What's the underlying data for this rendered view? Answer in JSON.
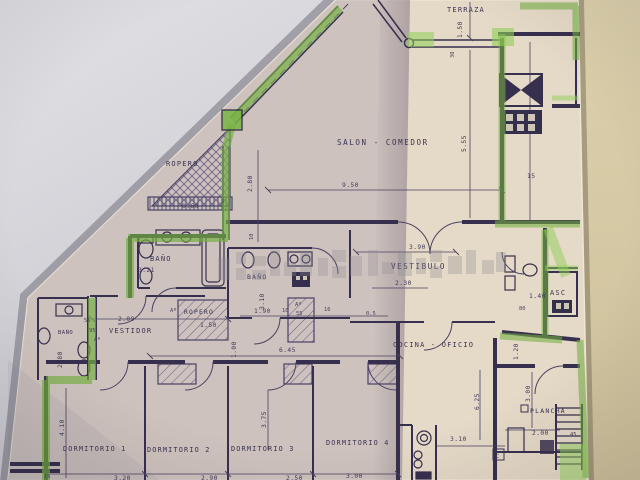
{
  "plan": {
    "rooms": {
      "terraza": "TERRAZA",
      "salon_comedor": "SALON - COMEDOR",
      "ropero_top": "ROPERO",
      "bano_left": "BAÑO",
      "bano_mid": "BAÑO",
      "bano_small": "BAÑO",
      "vestibulo": "VESTIBULO",
      "vestidor": "VESTIDOR",
      "ropero_mid": "ROPERO",
      "cocina_oficio": "COCINA - OFICIO",
      "dormitorio_1": "DORMITORIO 1",
      "dormitorio_2": "DORMITORIO 2",
      "dormitorio_3": "DORMITORIO 3",
      "dormitorio_4": "DORMITORIO 4",
      "plancha": "PLANCHA",
      "ascensor": "ASC"
    },
    "marks": {
      "closet": "Aº",
      "c_box": "C"
    },
    "dims": {
      "terraza_depth": "1.50",
      "terraza_rail": "30",
      "salon_width": "9.50",
      "salon_height": "5.55",
      "salon_left": "2.80",
      "shelf_depth": "0.60",
      "wall_tick_5": "5",
      "wall_tick_10": "10",
      "right_shaft": "15",
      "bano_left_width": "3.21",
      "vestibulo_width": "3.90",
      "vestibulo_inner": "2.30",
      "bano_mid_height": "3.10",
      "bano_mid_width": "1.90",
      "hall_tick_10": "10",
      "closet_depth_55": "55",
      "hall_tick_16": "16",
      "hall_tick_05": "0.5",
      "vestidor_width": "2.09",
      "left_tick_55": "55",
      "left_tick_95": "95",
      "bano_small_height": "2.80",
      "ropero_mid_width": "1.50",
      "pasillo_length": "6.45",
      "pasillo_width": "1.00",
      "asc_width": "1.40",
      "asc_tick_80": "80",
      "cocina_right": "1.20",
      "cocina_width": "3.10",
      "plancha_height": "3.00",
      "plancha_width": "2.00",
      "column_height": "6.25",
      "stairs_tick_45": "45",
      "dorm1_height": "4.10",
      "dorm3_height": "3.75",
      "dorm1_width": "3.20",
      "dorm2_width": "2.90",
      "dorm3_width": "2.50",
      "dorm4_width": "3.00",
      "bottom_tick_15": "15"
    },
    "colors": {
      "highlight_green": "#74b041",
      "ink": "#372f4e",
      "paper_warm": "#e5d9c7",
      "paper_cool": "#c9bfcb",
      "wall_left": "#d6d5da",
      "wall_right": "#d7caa6"
    }
  }
}
